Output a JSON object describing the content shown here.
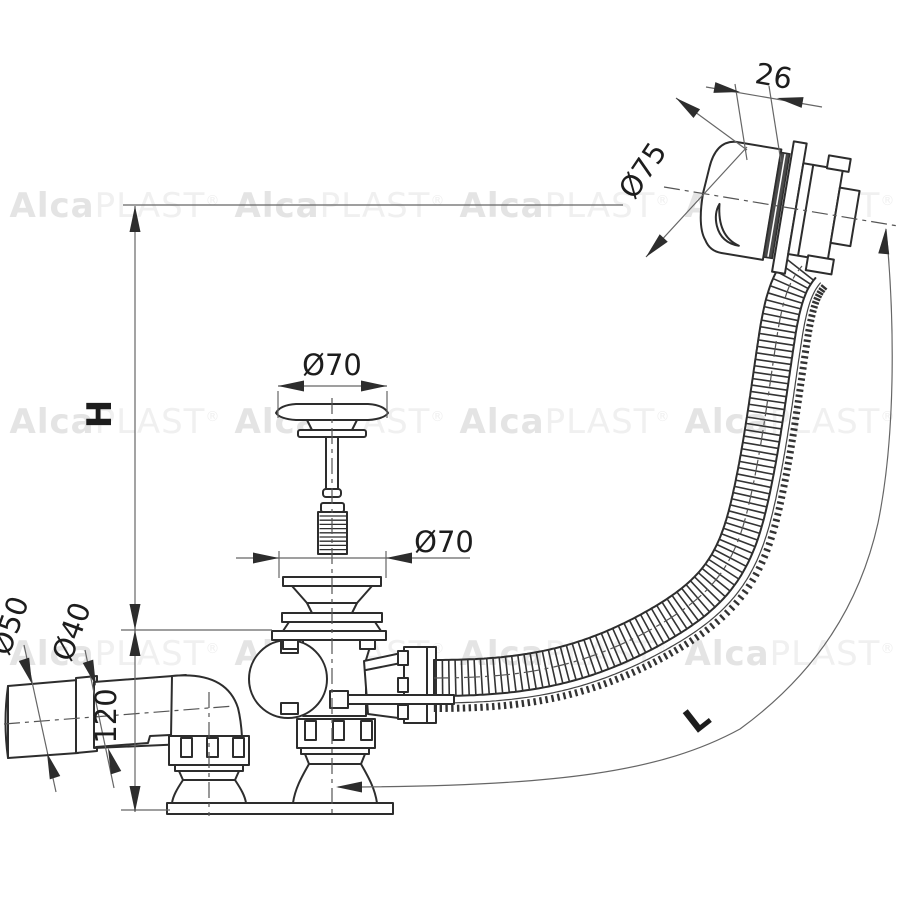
{
  "watermark": {
    "brand_bold": "Alca",
    "brand_light": "PLAST",
    "registered": "®"
  },
  "dimensions": {
    "knob_width": "26",
    "knob_diameter": "Ø75",
    "plug_diameter": "Ø70",
    "strainer_diameter": "Ø70",
    "outlet_socket_diameter": "Ø50",
    "outlet_pipe_diameter": "Ø40",
    "elbow_height": "120",
    "height_label": "H",
    "hose_length_label": "L"
  },
  "colors": {
    "background": "#ffffff",
    "line_main": "#2d2d2d",
    "line_thin": "#666666",
    "text": "#1d1d1d",
    "watermark_bold": "#e4e4e4",
    "watermark_light": "#f0f0f0"
  }
}
